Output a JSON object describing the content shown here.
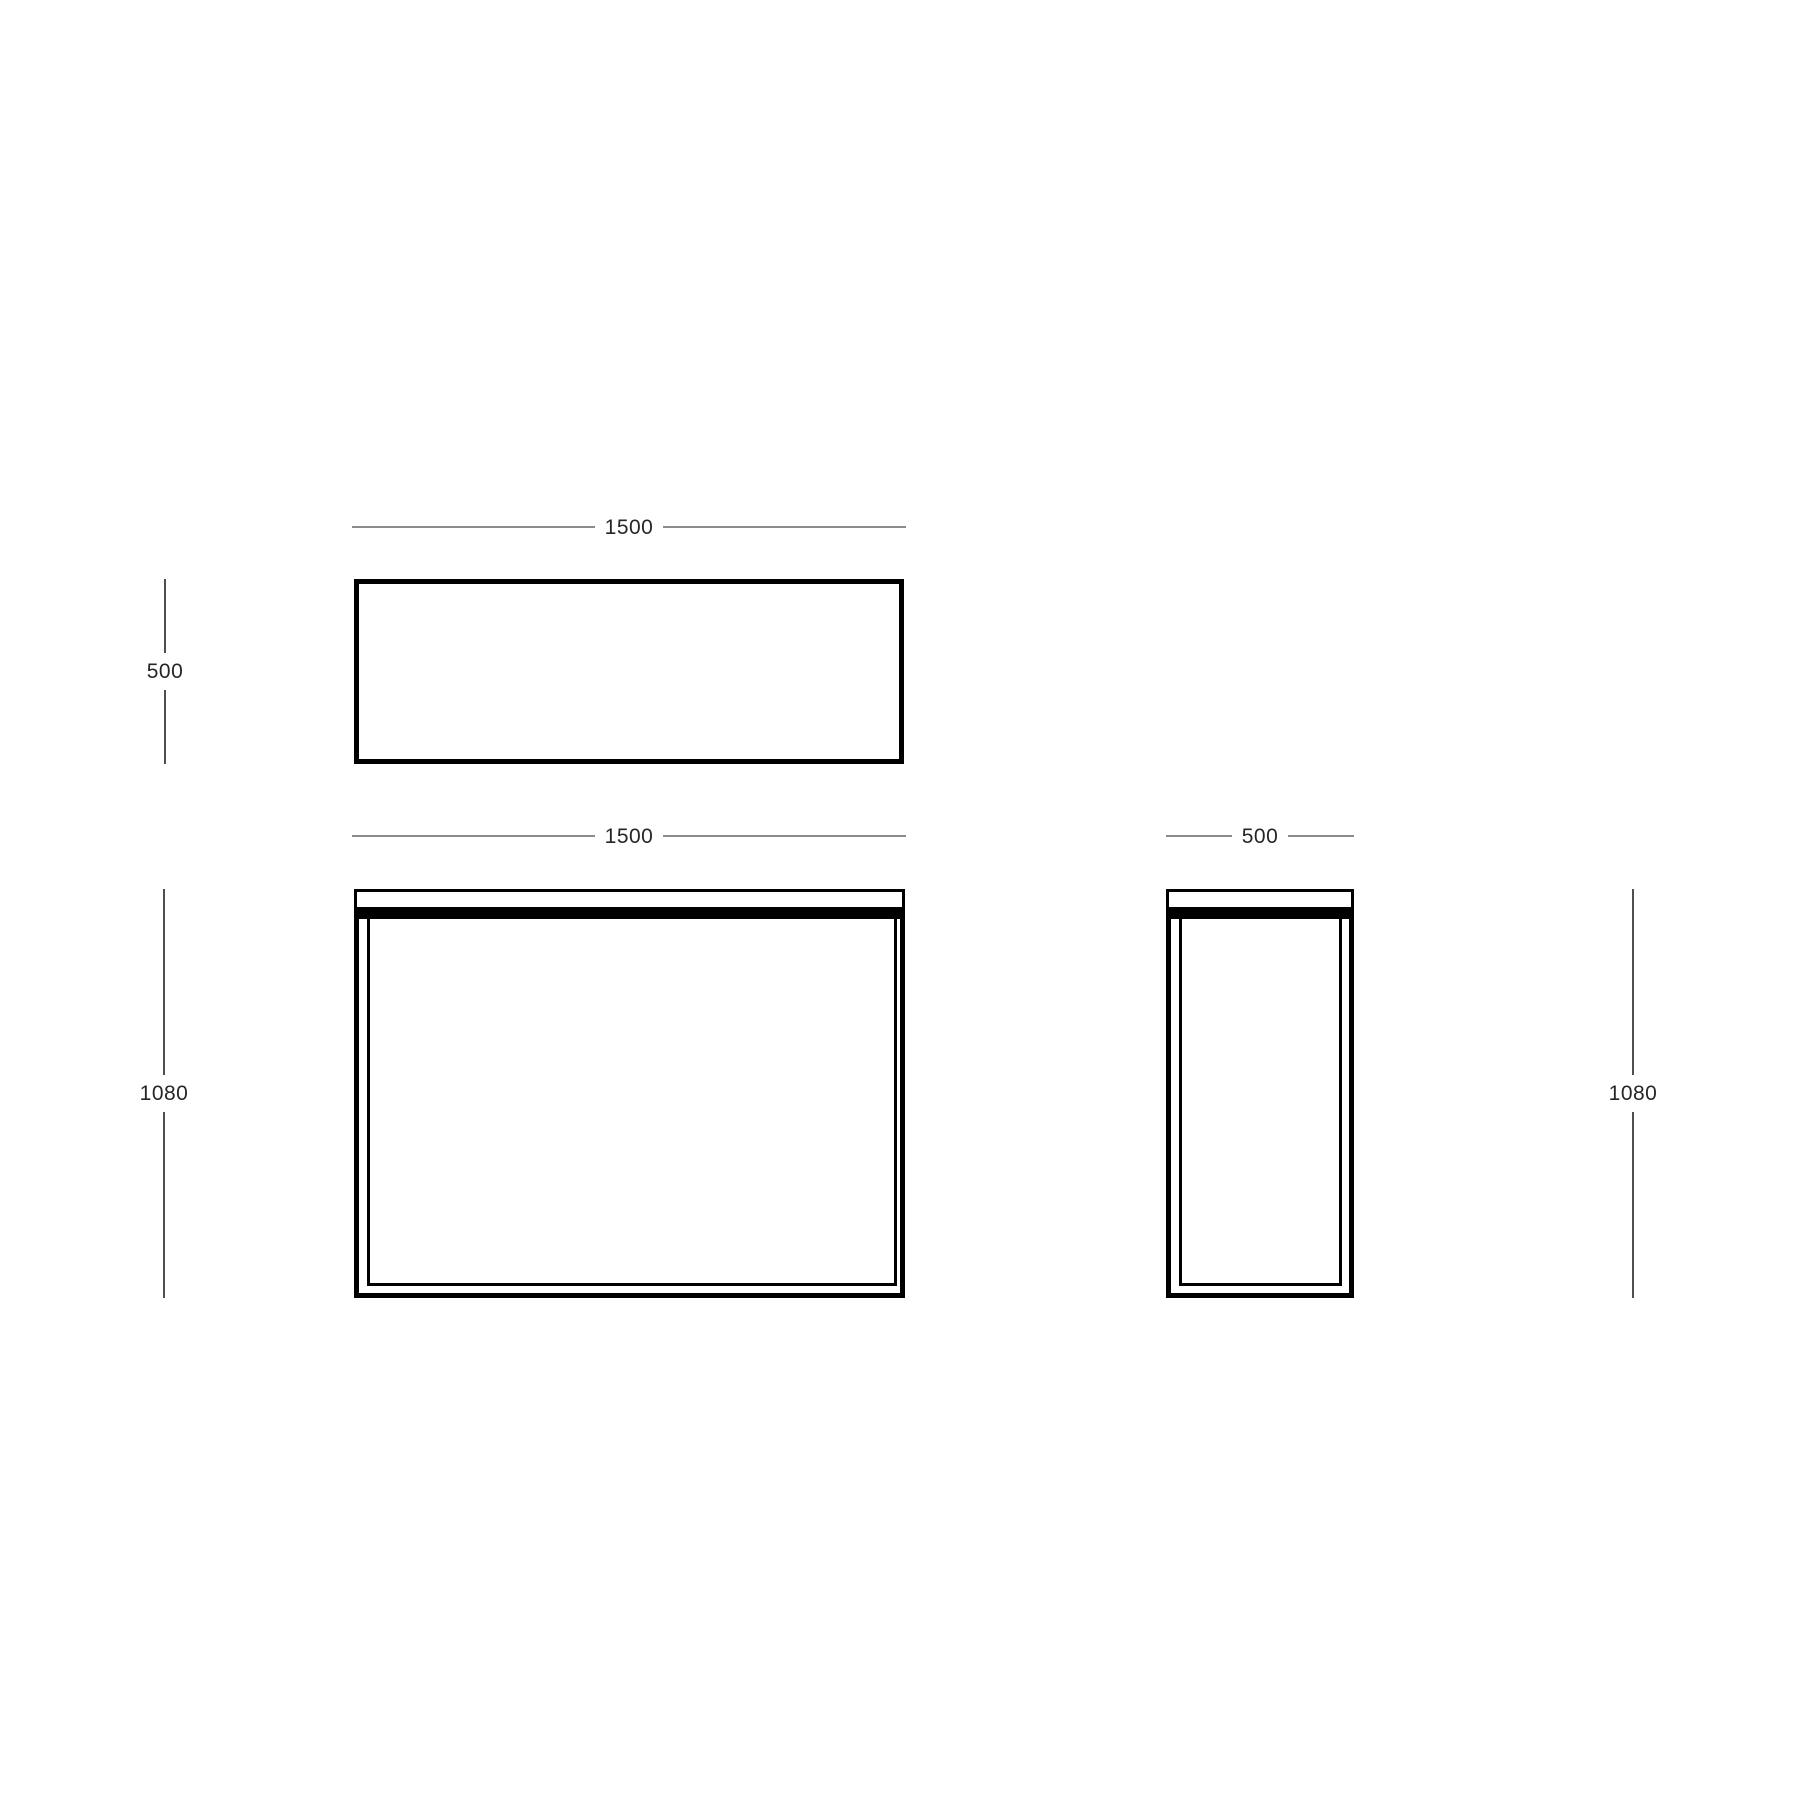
{
  "canvas": {
    "width_px": 1800,
    "height_px": 1800,
    "background": "#ffffff"
  },
  "colors": {
    "drawing_line": "#000000",
    "dimension_line_horizontal": "#8c8c8c",
    "dimension_line_vertical": "#4f4f4f",
    "dimension_text": "#262626"
  },
  "dimensions": {
    "top_view_width": "1500",
    "top_view_depth": "500",
    "front_view_width": "1500",
    "front_view_height": "1080",
    "side_view_width": "500",
    "side_view_height": "1080"
  }
}
